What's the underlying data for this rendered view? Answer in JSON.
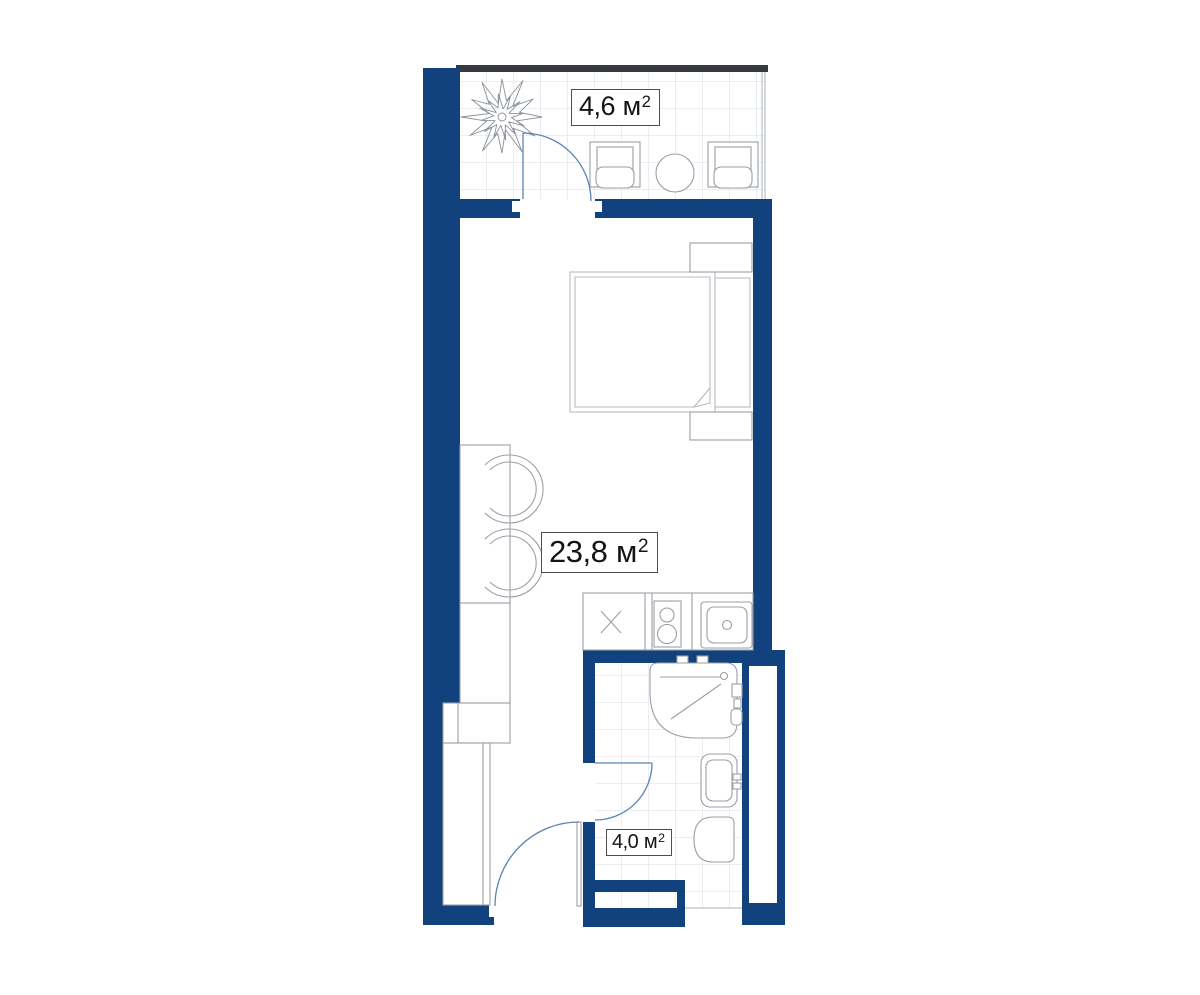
{
  "plan": {
    "type": "apartment-floor-plan",
    "rooms": [
      {
        "id": "balcony",
        "area_value": "4,6",
        "area_unit": "м",
        "area_exp": "2"
      },
      {
        "id": "studio-room",
        "area_value": "23,8",
        "area_unit": "м",
        "area_exp": "2"
      },
      {
        "id": "bathroom",
        "area_value": "4,0",
        "area_unit": "м",
        "area_exp": "2"
      }
    ],
    "colors": {
      "wall": "#12427e",
      "glazing": "#35393e",
      "tile_grid": "#d6dde6",
      "furniture": "#9aa0a7",
      "door": "#5b84b2"
    }
  }
}
